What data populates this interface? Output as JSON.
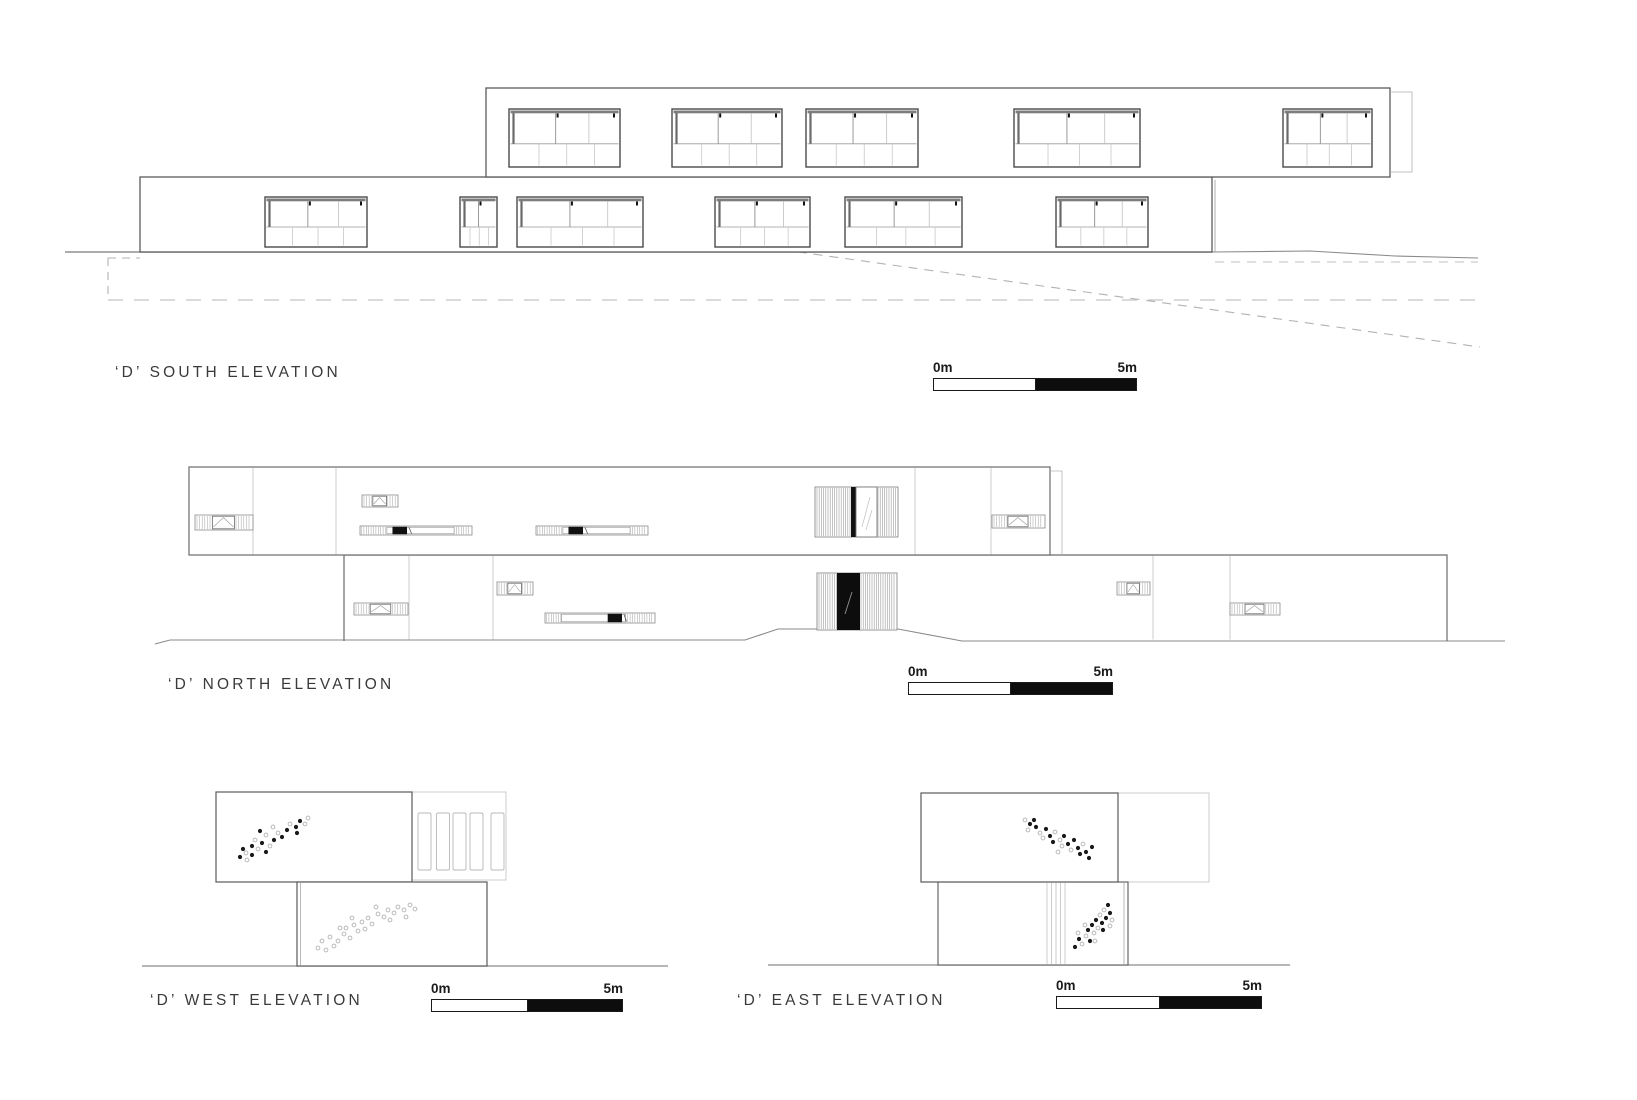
{
  "sheet": {
    "background": "#ffffff"
  },
  "colors": {
    "line_dark": "#555555",
    "line_mid": "#8a8a8a",
    "line_light": "#b8b8b8",
    "fill_black": "#111111",
    "text": "#3a3a3a"
  },
  "elevations": {
    "south": {
      "label": "‘D’ SOUTH ELEVATION",
      "scale": {
        "start": "0m",
        "end": "5m"
      }
    },
    "north": {
      "label": "‘D’ NORTH ELEVATION",
      "scale": {
        "start": "0m",
        "end": "5m"
      }
    },
    "west": {
      "label": "‘D’ WEST ELEVATION",
      "scale": {
        "start": "0m",
        "end": "5m"
      }
    },
    "east": {
      "label": "‘D’ EAST ELEVATION",
      "scale": {
        "start": "0m",
        "end": "5m"
      }
    }
  }
}
